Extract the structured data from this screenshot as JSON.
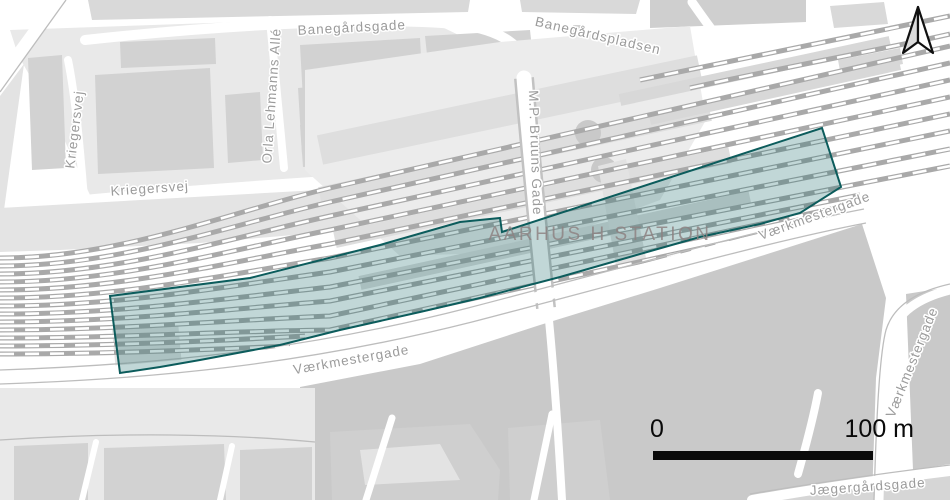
{
  "map": {
    "station_label": "AARHUS H STATION",
    "streets": {
      "banegardsgade": "Banegårdsgade",
      "banegardspladsen": "Banegårdspladsen",
      "kriegersvej_vertical": "Kriegersvej",
      "kriegersvej_horizontal": "Kriegersvej",
      "orla_lehmanns_alle": "Orla Lehmanns Allé",
      "mp_bruuns_gade": "M.P. Bruuns Gade",
      "vaerkmestergade_south": "Værkmestergade",
      "vaerkmestergade_east": "Værkmestergade",
      "vaerkmestergade_right": "Værkmestergade",
      "jaegergardsgade": "Jægergårdsgade"
    },
    "scale_bar": {
      "zero_label": "0",
      "max_label": "100 m"
    },
    "north_arrow_icon": "north-arrow",
    "overlay": {
      "fill": "#1a6a6a",
      "fill_opacity": "0.27",
      "stroke": "#0c5c5c"
    },
    "colors": {
      "background_street": "#ffffff",
      "city_block": "#e9e9e9",
      "building": "#d2d2d2",
      "south_area": "#c9c9c9",
      "railway_track": "#a9a9a9",
      "track_dash": "#ffffff",
      "street_label": "#9b9b9b",
      "station_label": "#8d8181",
      "scale_bar": "#000000"
    }
  }
}
